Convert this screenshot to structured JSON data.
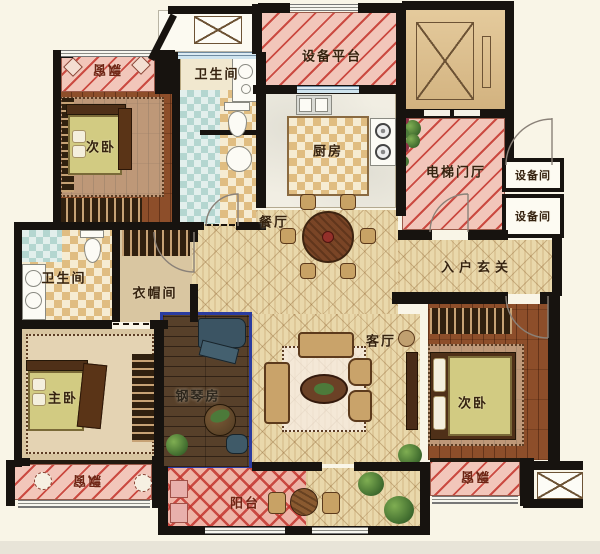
{
  "plan": {
    "title": "apartment-floor-plan",
    "rooms": {
      "bay_tl": "飘窗",
      "bedroom_tl": "次卧",
      "bath_top": "卫生间",
      "platform": "设备平台",
      "kitchen": "厨房",
      "elevator_hall": "电梯门厅",
      "equip_top": "设备间",
      "equip_bottom": "设备间",
      "dining": "餐厅",
      "foyer": "入户玄关",
      "bath_left": "卫生间",
      "cloak": "衣帽间",
      "master": "主卧",
      "piano": "钢琴房",
      "living": "客厅",
      "bedroom_br": "次卧",
      "bay_bl": "飘窗",
      "balcony": "阳台",
      "bay_br": "飘窗"
    },
    "colors": {
      "wall": "#17130f",
      "paper": "#f9f5e7",
      "hatch_pink": "#f2c6ba",
      "hatch_red": "#c43430",
      "tile": "#e9d8ab",
      "wood": "#8d4e2a",
      "piano_border": "#2b3ca0"
    }
  }
}
